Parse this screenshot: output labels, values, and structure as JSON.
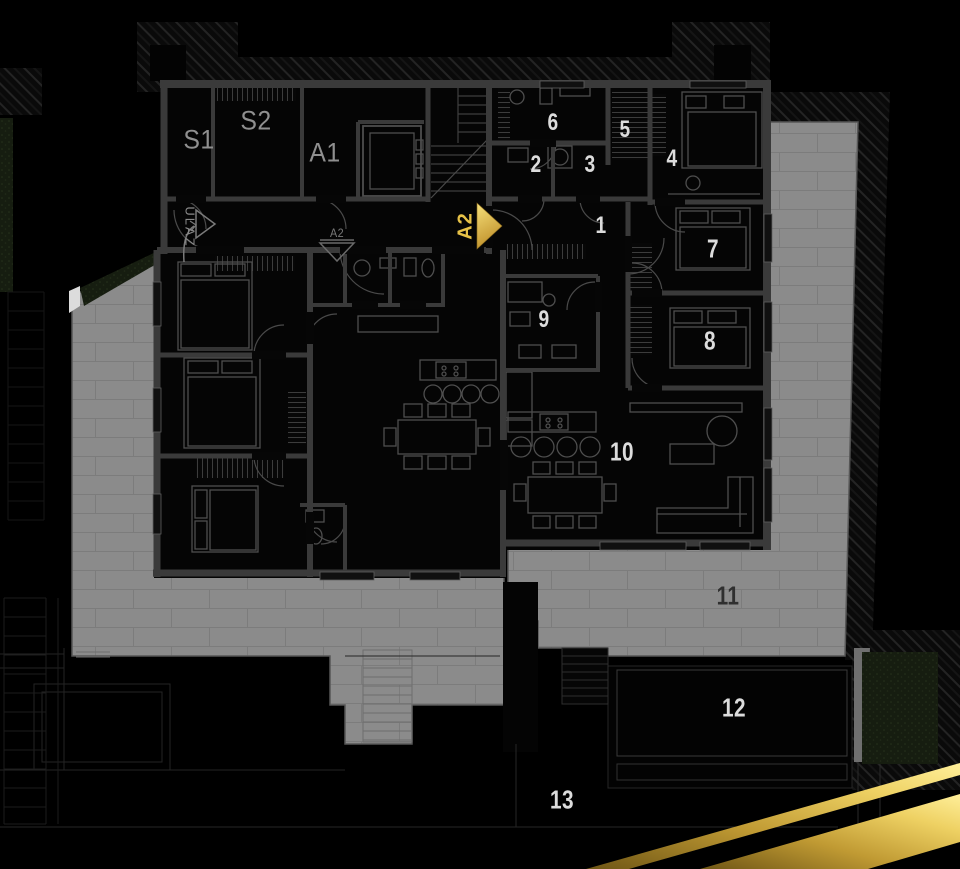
{
  "floor_plan": {
    "storage_labels": {
      "s1": "S1",
      "s2": "S2"
    },
    "unit_labels": {
      "a1": "A1",
      "a2": "A2"
    },
    "entrance_label": "ULAZ",
    "section_marker_label": "A2",
    "room_numbers": {
      "r1": "1",
      "r2": "2",
      "r3": "3",
      "r4": "4",
      "r5": "5",
      "r6": "6",
      "r7": "7",
      "r8": "8",
      "r9": "9",
      "r10": "10",
      "r11": "11",
      "r12": "12",
      "r13": "13"
    }
  },
  "icons": {
    "unit_a2_marker": "gold-arrow-right-icon",
    "entrance_marker": "triangle-right-outline-icon",
    "section_marker": "triangle-down-outline-icon"
  },
  "colors": {
    "background": "#000000",
    "terrace_gray": "#8b8b8b",
    "tile_line": "#7c7c7c",
    "wall_gray": "#3a3a3a",
    "room_black": "#060606",
    "greenery_dark": "#161d10",
    "gold_dark": "#6f5615",
    "gold_bright": "#ffef9a",
    "accent_gold_text": "#e7c247",
    "room_number_light": "#dcdcdc",
    "room_number_dark": "#2f2f2f",
    "unit_label_gray": "#8f8f8f"
  }
}
